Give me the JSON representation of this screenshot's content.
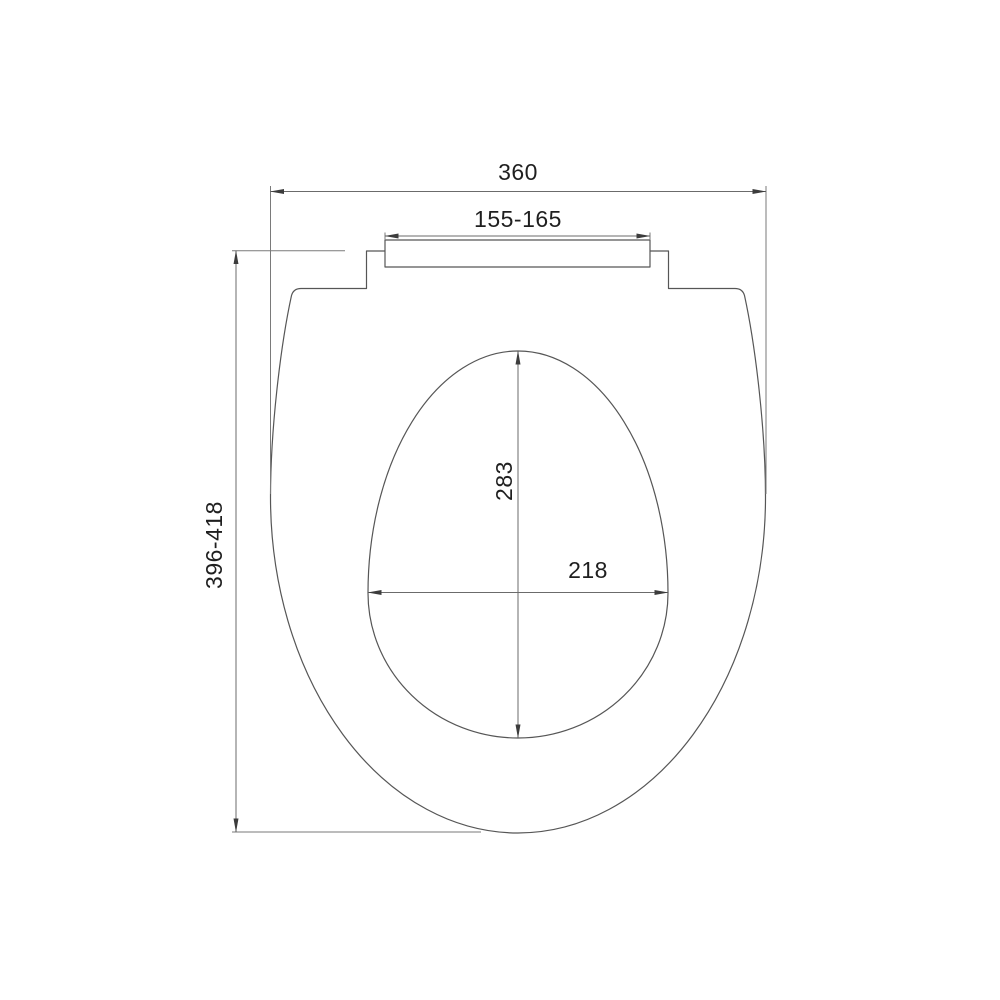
{
  "drawing": {
    "type": "technical-dimension-drawing",
    "subject": "toilet seat lid, top view",
    "background_color": "#ffffff",
    "outline_color": "#565656",
    "dimension_line_color": "#6b6b6b",
    "text_color": "#1f1f1f",
    "dimensions": {
      "overall_width": {
        "label": "360",
        "measures": "overall seat width, top horizontal dimension"
      },
      "hinge_span": {
        "label": "155-165",
        "measures": "hinge fixing bar span"
      },
      "overall_length": {
        "label": "396-418",
        "measures": "overall seat length, left vertical dimension"
      },
      "cutout_length": {
        "label": "283",
        "measures": "inner opening length, vertical"
      },
      "cutout_width": {
        "label": "218",
        "measures": "inner opening width, horizontal"
      }
    }
  }
}
